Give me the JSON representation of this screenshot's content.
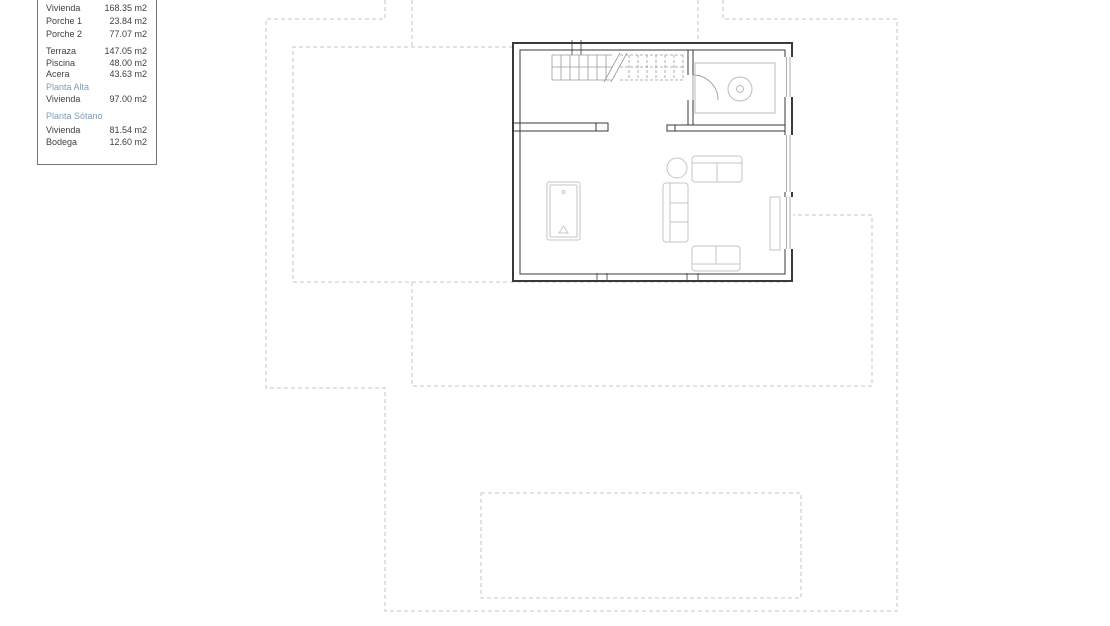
{
  "colors": {
    "heading_text": "#7e9db7",
    "body_text": "#3f3f3f",
    "legend_border": "#777777",
    "wall": "#3a3a3a",
    "dashed_boundary": "#c4c4c4",
    "stairs": "#9a9a9a",
    "furniture": "#c6c6c6",
    "fixture": "#bdbdbd"
  },
  "legend": {
    "groups": [
      {
        "items": [
          {
            "label": "Vivienda",
            "value": "168.35 m2"
          },
          {
            "label": "Porche 1",
            "value": "23.84 m2"
          },
          {
            "label": "Porche 2",
            "value": "77.07 m2"
          }
        ]
      },
      {
        "items": [
          {
            "label": "Terraza",
            "value": "147.05 m2"
          },
          {
            "label": "Piscina",
            "value": "48.00 m2"
          },
          {
            "label": "Acera",
            "value": "43.63 m2"
          }
        ]
      },
      {
        "heading": "Planta Alta",
        "items": [
          {
            "label": "Vivienda",
            "value": "97.00 m2"
          }
        ]
      },
      {
        "heading": "Planta Sótano",
        "items": [
          {
            "label": "Vivienda",
            "value": "81.54 m2"
          },
          {
            "label": "Bodega",
            "value": "12.60 m2"
          }
        ]
      }
    ]
  }
}
